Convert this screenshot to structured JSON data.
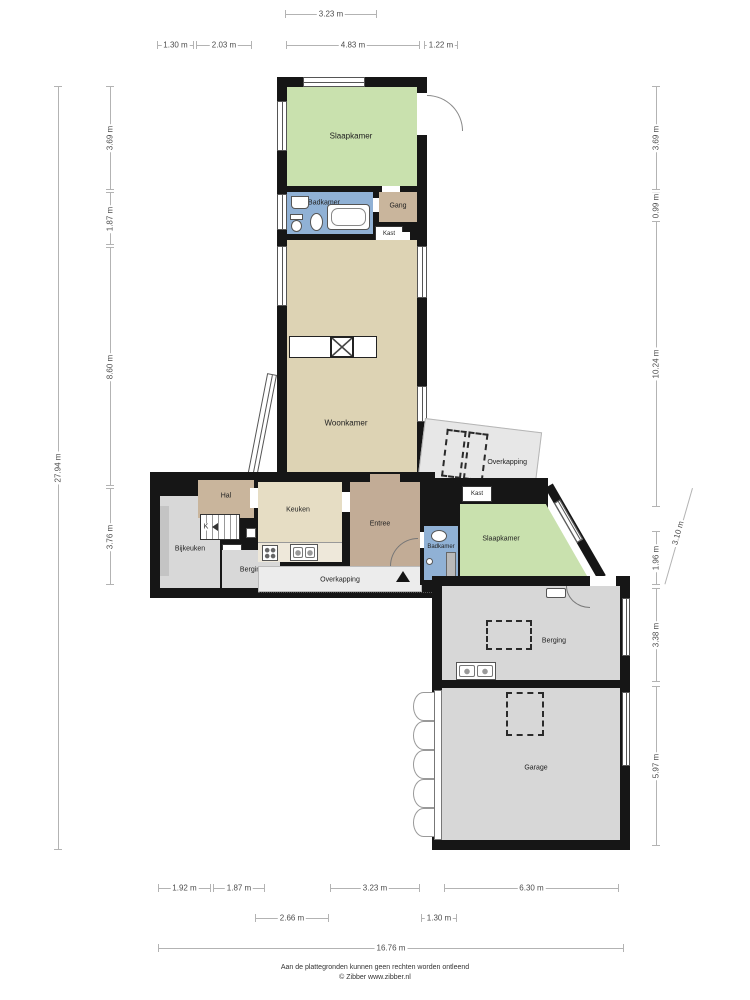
{
  "plan": {
    "rooms": {
      "slaapkamer_top": "Slaapkamer",
      "badkamer_top": "Badkamer",
      "gang": "Gang",
      "kast_top": "Kast",
      "woonkamer": "Woonkamer",
      "overkapping_right": "Overkapping",
      "hal": "Hal",
      "keuken": "Keuken",
      "entree": "Entree",
      "kast_mid": "Kast",
      "slaapkamer_mid": "Slaapkamer",
      "bijkeuken": "Bijkeuken",
      "stairs_label": "K",
      "closet_label": "K",
      "berging_small": "Berging",
      "badkamer_mid": "Badkamer",
      "overkapping_bottom": "Overkapping",
      "berging_garage": "Berging",
      "garage": "Garage"
    },
    "dimensions": {
      "top_row1": [
        "3.23 m"
      ],
      "top_row2": [
        "1.30 m",
        "2.03 m",
        "4.83 m",
        "1.22 m"
      ],
      "left_inner": [
        "3.69 m",
        "1.87 m",
        "8.60 m",
        "3.76 m"
      ],
      "left_outer": [
        "27.94 m"
      ],
      "right_inner": [
        "3.69 m",
        "0.99 m",
        "10.24 m",
        "1.96 m",
        "3.38 m",
        "5.97 m"
      ],
      "right_angled": [
        "3.10 m"
      ],
      "bottom_row1": [
        "1.92 m",
        "1.87 m",
        "3.23 m",
        "6.30 m"
      ],
      "bottom_row2": [
        "2.66 m",
        "1.30 m"
      ],
      "bottom_row3": [
        "16.76 m"
      ]
    },
    "colors": {
      "bedroom_green": "#c9e1ae",
      "bathroom_blue": "#90b1d5",
      "hall_tan": "#c9b59c",
      "entree_tan": "#c2ac96",
      "living_beige": "#ddd3b4",
      "kitchen_beige": "#e6ddc4",
      "utility_gray": "#d8d8d8",
      "canopy_gray": "#ececec",
      "wall_black": "#161616"
    },
    "footer": {
      "disclaimer": "Aan de plattegronden kunnen geen rechten worden ontleend",
      "credit": "© Zibber www.zibber.nl"
    }
  }
}
